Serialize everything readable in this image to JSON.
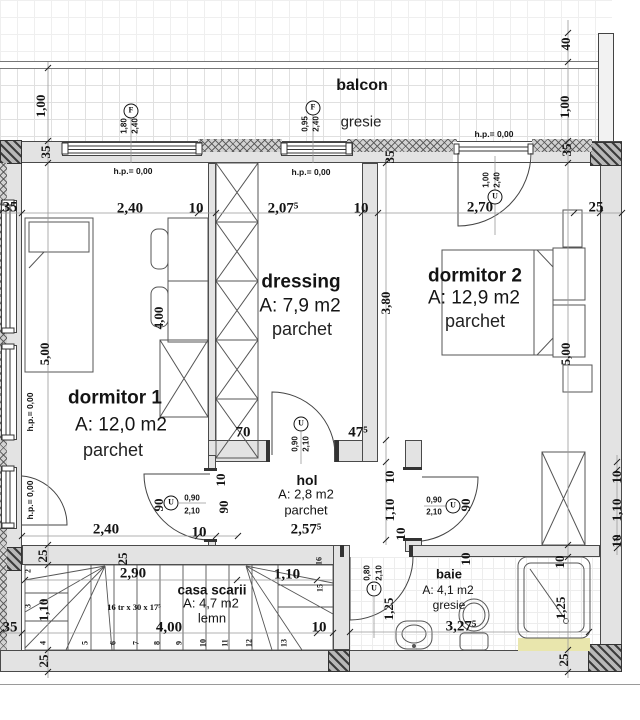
{
  "balcony": {
    "label": "balcon",
    "finish": "gresie"
  },
  "rooms": {
    "dormitor1": {
      "name": "dormitor 1",
      "area": "A: 12,0 m2",
      "finish": "parchet"
    },
    "dressing": {
      "name": "dressing",
      "area": "A: 7,9 m2",
      "finish": "parchet"
    },
    "dormitor2": {
      "name": "dormitor 2",
      "area": "A: 12,9 m2",
      "finish": "parchet"
    },
    "hol": {
      "name": "hol",
      "area": "A: 2,8 m2",
      "finish": "parchet"
    },
    "baie": {
      "name": "baie",
      "area": "A: 4,1 m2",
      "finish": "gresie"
    },
    "casa_scarii": {
      "name": "casa scarii",
      "area": "A: 4,7 m2",
      "finish": "lemn",
      "stairs_spec": "16 tr x 30 x 17⁵"
    }
  },
  "openings": {
    "level_label": "h.p.= 0,00",
    "window1": {
      "symbol": "F",
      "width": "1,80",
      "height": "2,40"
    },
    "window2": {
      "symbol": "F",
      "width": "0,95",
      "height": "2,40"
    },
    "balcony_door": {
      "symbol": "U",
      "width": "1,00",
      "height": "2,40"
    },
    "dressing_door": {
      "symbol": "U",
      "width": "0,90",
      "height": "2,10"
    },
    "dormitor1_door": {
      "symbol": "U",
      "width": "0,90",
      "height": "2,10"
    },
    "dormitor2_door": {
      "symbol": "U",
      "width": "0,90",
      "height": "2,10"
    },
    "baie_door": {
      "symbol": "U",
      "width": "0,80",
      "height": "2,10"
    }
  },
  "dimensions": {
    "wall_thickness": "35",
    "top_chain": [
      "35",
      "2,40",
      "10",
      "2,07⁵",
      "10",
      "2,70",
      "25"
    ],
    "balcony_depth": "1,00",
    "parapet": "40",
    "dormitor1": {
      "height": "5,00",
      "inner": "4,00",
      "bottom_width": "2,40",
      "wall10": "10",
      "wall25": "25"
    },
    "dressing": {
      "height": "3,80",
      "door_left": "70",
      "door_right": "47⁵"
    },
    "dormitor2": {
      "height": "5,00"
    },
    "hol": {
      "width": "2,57⁵",
      "depth": "1,10",
      "wall10": "10",
      "door90": "90"
    },
    "baie": {
      "width": "3,27⁵",
      "depth": "1,25",
      "wall10": "10",
      "wall25": "25"
    },
    "stairs": {
      "run": "2,90",
      "landing": "1,10",
      "total": "4,00",
      "width": "1,10",
      "wall35": "35",
      "wall25": "25",
      "wall10": "10"
    },
    "treads": [
      "2",
      "3",
      "4",
      "5",
      "6",
      "7",
      "8",
      "9",
      "10",
      "11",
      "12",
      "13",
      "15",
      "16"
    ]
  }
}
